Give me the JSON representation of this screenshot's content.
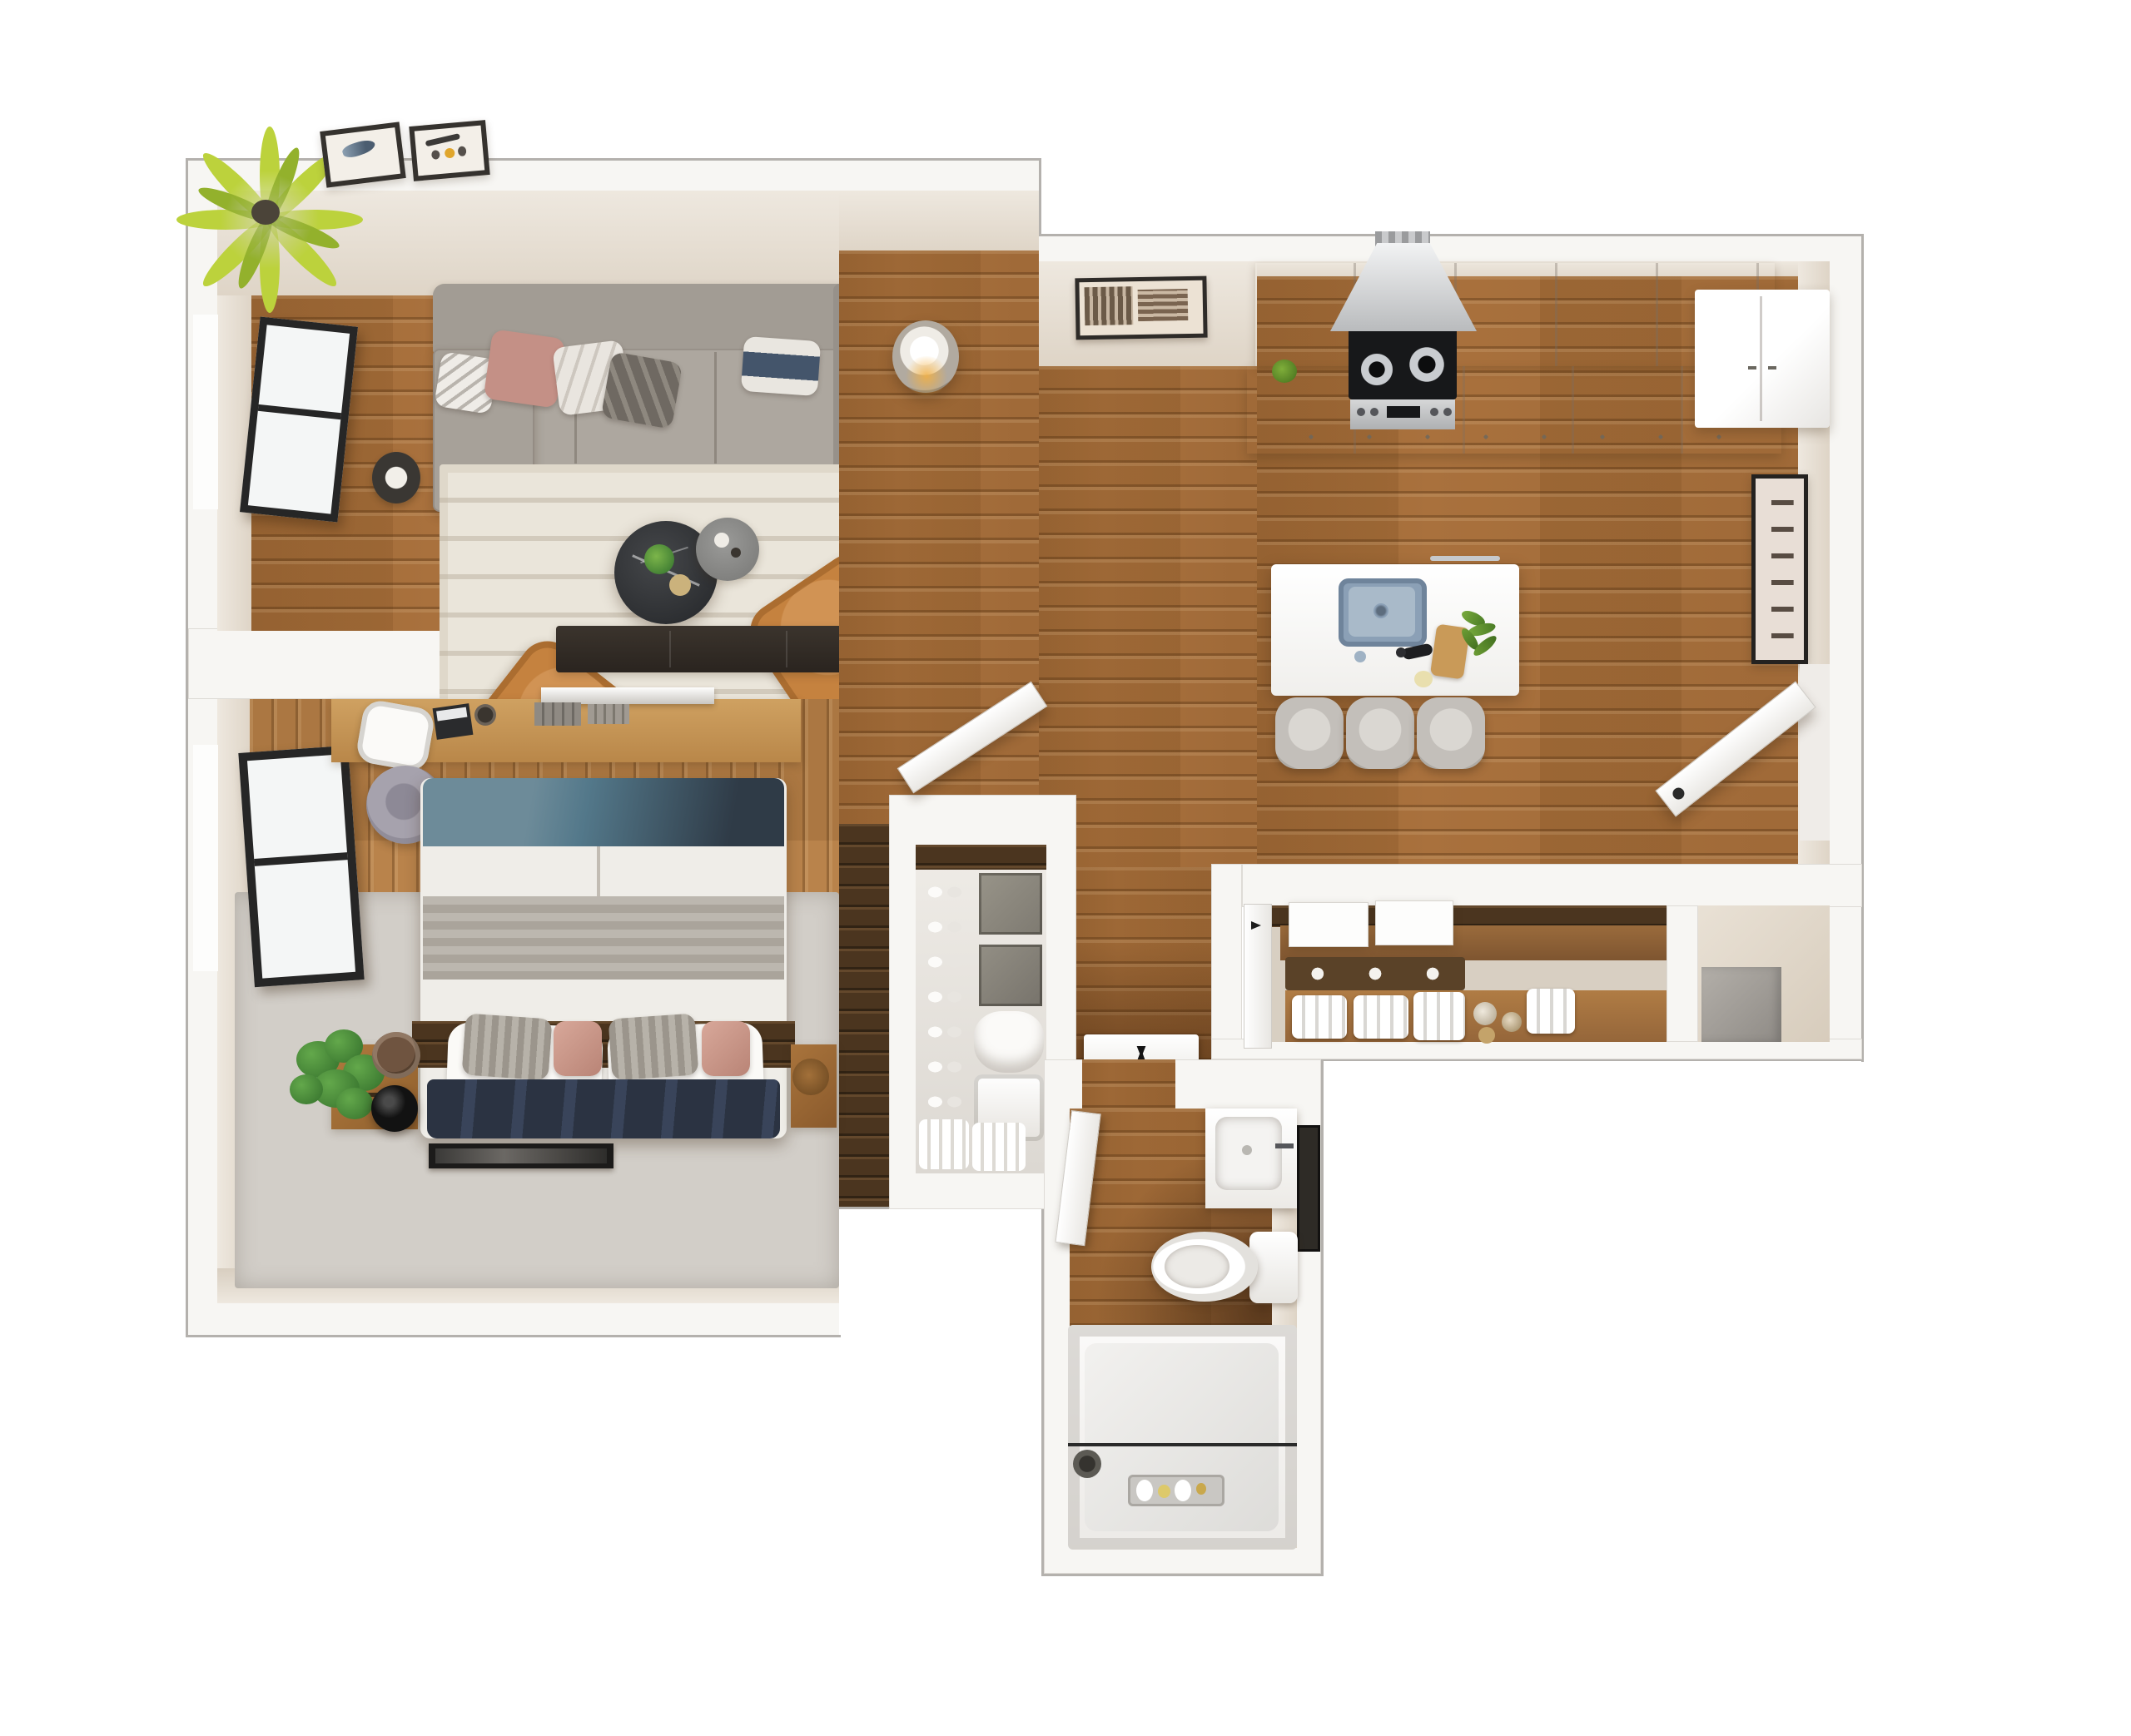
{
  "scene": {
    "kind": "3d-floor-plan-top-down-render",
    "unit_style": "one-bedroom-apartment",
    "background": "#ffffff"
  },
  "palette": {
    "outline_gray": "#b4b1ad",
    "wall_white": "#f7f6f3",
    "plaster_beige": "#eee8df",
    "floor_wood": "#a9713d",
    "floor_wood_bedroom": "#b9834b",
    "accent_dark_wood": "#4b351f",
    "rug_cream": "#eae5da",
    "rug_gray": "#d2cec8",
    "sofa_gray": "#a49e96",
    "chair_tan": "#c5823f",
    "sink_blue": "#8ba0b6",
    "palm_green": "#bcd23c",
    "plant_green": "#4c8a39",
    "lamp_glow": "#f0a93c",
    "navy_textile": "#2b3342",
    "teal_textile": "#53788a"
  },
  "rooms": {
    "living": {
      "label": "living-room",
      "furniture": [
        "sofa",
        "chaise",
        "area-rug",
        "coffee-table",
        "side-table",
        "accent-chair-left",
        "accent-chair-right",
        "tv-console",
        "floor-lamp",
        "palm-plant",
        "wall-art-frames",
        "casement-window"
      ]
    },
    "open_area": {
      "label": "open-plan-main-area",
      "furniture": [
        "floor-lamp",
        "niche-wall-art"
      ]
    },
    "kitchen": {
      "label": "kitchen",
      "furniture": [
        "upper-cabinets",
        "counter-run",
        "range",
        "range-hood",
        "refrigerator",
        "island",
        "island-sink",
        "faucet",
        "cutting-board",
        "herbs",
        "bar-stools"
      ]
    },
    "entry": {
      "label": "entry",
      "furniture": [
        "entry-door",
        "vertical-wall-art"
      ]
    },
    "bedroom": {
      "label": "bedroom",
      "furniture": [
        "desk",
        "desk-chair",
        "laptop",
        "wall-shelf",
        "hat",
        "double-bed",
        "pillows",
        "nightstand-left",
        "nightstand-right",
        "fiddle-plant",
        "black-vase",
        "floor-frame",
        "gray-rug",
        "casement-window"
      ]
    },
    "walk_in_closet": {
      "label": "walk-in-closet",
      "furniture": [
        "shoe-rack",
        "storage-boxes",
        "pillows",
        "hamper",
        "baskets",
        "bedroom-door"
      ]
    },
    "hallway": {
      "label": "hallway",
      "furniture": [
        "floor-mat",
        "decor-vase"
      ]
    },
    "linen_closet": {
      "label": "linen-closet",
      "furniture": [
        "closet-door",
        "white-boxes",
        "baskets-with-rolls",
        "towel-stacks",
        "jars"
      ]
    },
    "utility_closet": {
      "label": "utility-closet",
      "furniture": [
        "utility-unit"
      ]
    },
    "bathroom": {
      "label": "bathroom",
      "furniture": [
        "bathroom-door",
        "vanity",
        "sink-basin",
        "mirror",
        "toilet",
        "bathtub",
        "shower-rod",
        "shower-head",
        "bath-caddy"
      ]
    }
  }
}
